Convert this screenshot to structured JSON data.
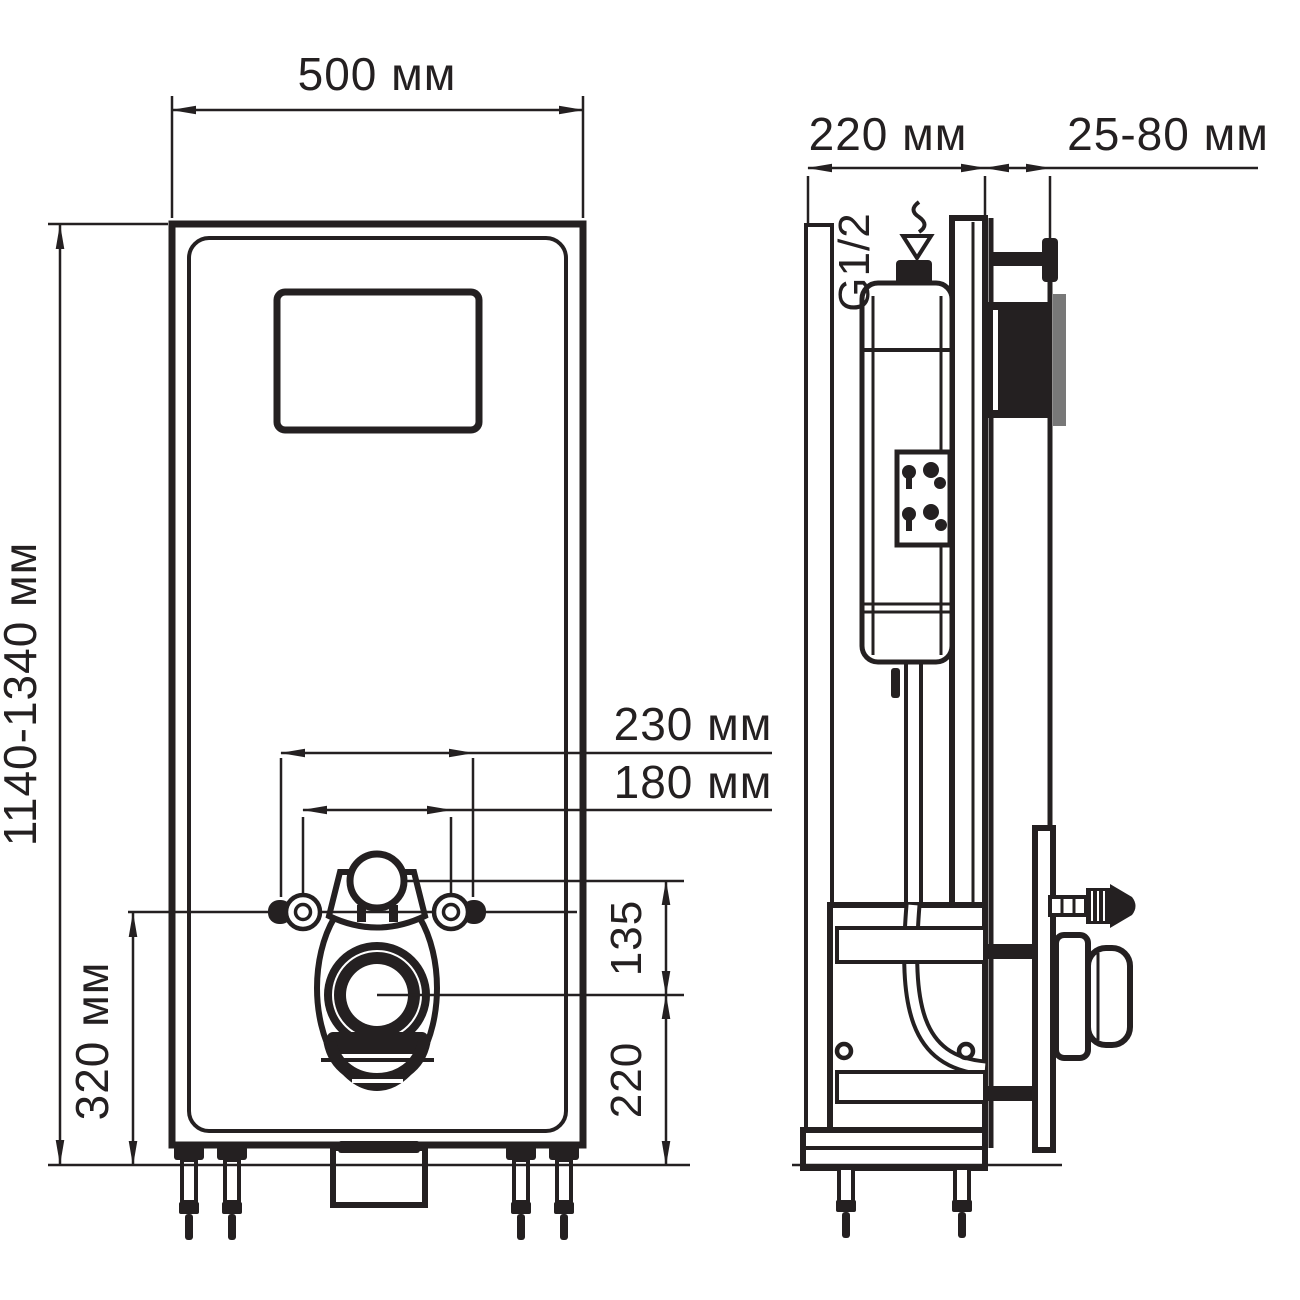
{
  "colors": {
    "ink": "#242021",
    "background": "#ffffff",
    "plate_gray": "#787878"
  },
  "front_view": {
    "width": "500 мм",
    "height": "1140-1340 мм",
    "mount_spacing_wide": "230 мм",
    "mount_spacing_narrow": "180 мм",
    "flush_to_outlet": "135",
    "outlet_height": "220",
    "mount_height": "320 мм"
  },
  "side_view": {
    "depth": "220 мм",
    "wall_offset": "25-80 мм",
    "inlet_thread": "G1/2"
  }
}
